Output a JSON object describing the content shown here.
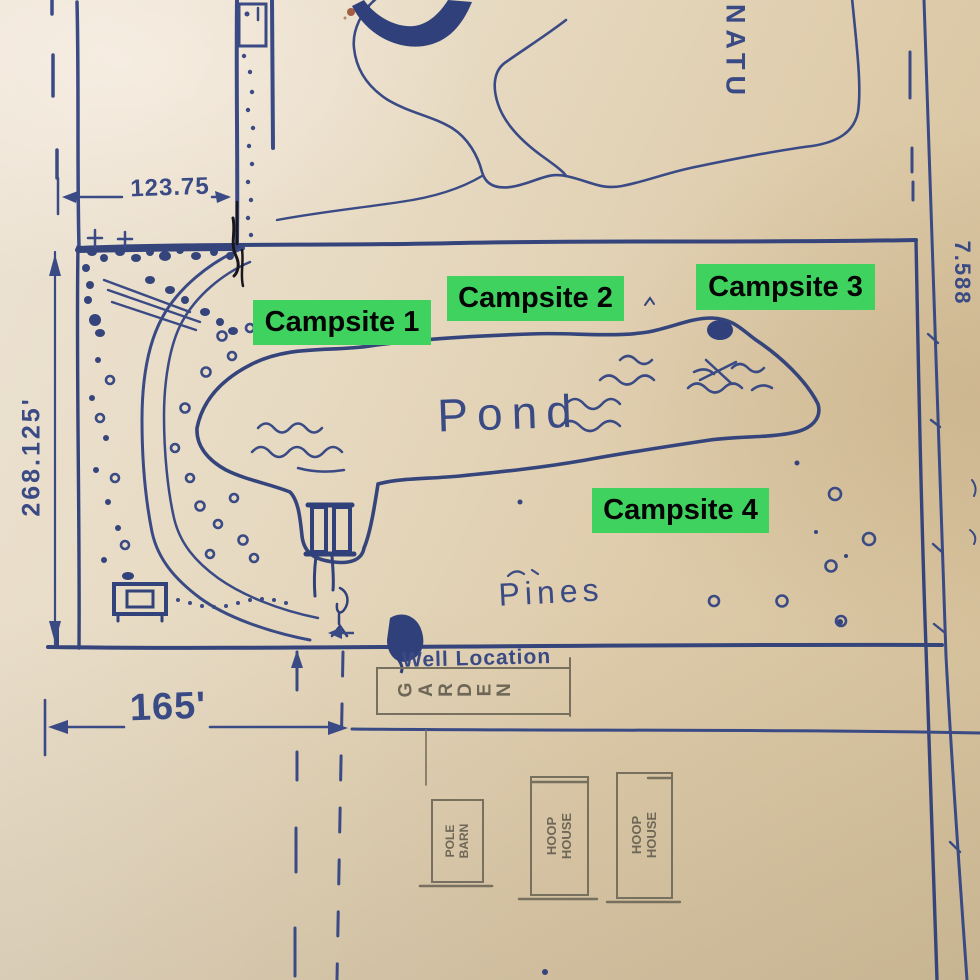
{
  "overlay_labels": [
    {
      "id": "campsite-1",
      "label": "Campsite 1"
    },
    {
      "id": "campsite-2",
      "label": "Campsite 2"
    },
    {
      "id": "campsite-3",
      "label": "Campsite 3"
    },
    {
      "id": "campsite-4",
      "label": "Campsite 4"
    }
  ],
  "map_text": {
    "pond": "Pond",
    "pines": "Pines",
    "nature_partial": "NATU",
    "well_location": "Well Location",
    "garden": "GARDEN",
    "pole_barn": {
      "line1": "POLE",
      "line2": "BARN"
    },
    "hoop_house_1": {
      "line1": "HOOP",
      "line2": "HOUSE"
    },
    "hoop_house_2": {
      "line1": "HOOP",
      "line2": "HOUSE"
    },
    "dim_top": "123.75",
    "dim_left": "268.125'",
    "dim_bottom": "165'",
    "dim_right_partial": "7.588"
  },
  "colors": {
    "ink_blue": "#3a4a84",
    "ink_blue_heavy": "#30407a",
    "pencil_gray": "#6e6757",
    "label_green": "#3fd25f",
    "label_text": "#050505",
    "paper_light": "#ede4d6",
    "paper_dark": "#d4bf98",
    "black_ink": "#17171c",
    "stain_red": "#94482a"
  }
}
